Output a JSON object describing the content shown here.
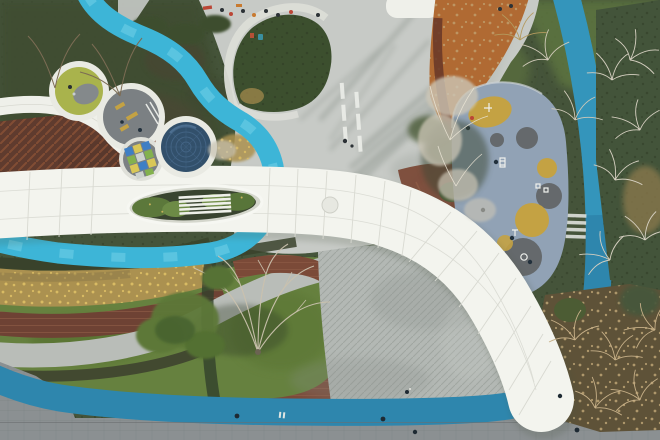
{
  "scene": {
    "type": "aerial-photograph",
    "subject": "Top-down drone view of a landscaped urban park: a white curving ribbon canopy with a planted skylight, winding cyan and teal running paths, a cluster of circular play pods, a fitness playground with yellow and grey circles, lawns, a timber deck plaza, brick loop path, autumn shrubs and bare trees, pedestrians as small dots"
  },
  "palette": {
    "canopy_white": "#f3f4ee",
    "canopy_seam": "#d8d9d1",
    "plaza_gray": "#c7cac6",
    "deck_gray": "#b3b8b4",
    "cyan_path": "#3db5d7",
    "teal_track": "#2e86ad",
    "lawn_green": "#66813f",
    "dark_foliage": "#45543a",
    "golden_shrub": "#ab9150",
    "rust_path": "#b06a33",
    "brick_path": "#7b4a38",
    "boardwalk_brown": "#5f3b2e",
    "playground_blue": "#91a2b5",
    "playground_yellow": "#c4a243",
    "playground_dark": "#65696c",
    "navy_circle": "#32506b",
    "circle_lime": "#a9b34c",
    "circle_gray": "#7b8083",
    "pavement_gray": "#8b9092",
    "people_red": "#bb4636"
  },
  "elements": [
    {
      "name": "ribbon-canopy",
      "description": "white curved canopy band sweeping from left edge to bottom right, panel seams, oval skylight planter with white louvers"
    },
    {
      "name": "cyan-winding-path",
      "description": "bright cyan path winding from top edge under the canopy to the left edge"
    },
    {
      "name": "teal-track",
      "description": "steel-teal jogging track along bottom edge rising up the right side"
    },
    {
      "name": "play-pods",
      "description": "four circular sunken pods: lime play pod, grey equipment pod, hopscotch tile pod, navy mound pod"
    },
    {
      "name": "fitness-playground",
      "description": "grey-blue rubber surface with yellow and dark grey circles and white exercise equipment"
    },
    {
      "name": "plaza",
      "description": "light concrete plaza with long tree shadows, white pavement bars and a green island"
    },
    {
      "name": "timber-deck",
      "description": "grey diagonal plank deck plaza"
    },
    {
      "name": "brick-loop",
      "description": "red-brown brick path looping around central lawn with bare tree"
    },
    {
      "name": "rust-path",
      "description": "rust-orange leaf-covered walk at top right"
    },
    {
      "name": "pedestrians",
      "description": "small dark, red and orange figures on paths and track"
    }
  ]
}
